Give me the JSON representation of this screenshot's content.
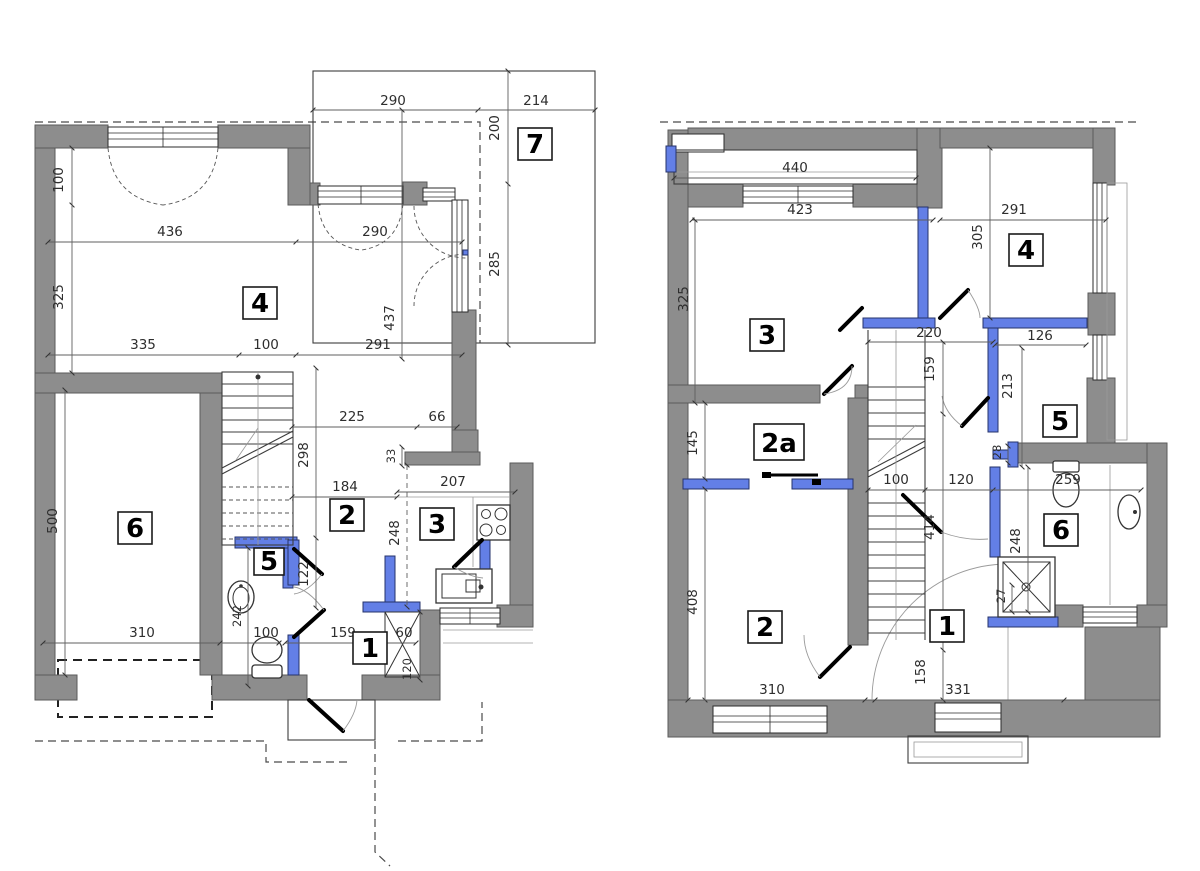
{
  "colors": {
    "wall_gray": "#8d8d8d",
    "partition_blue": "#637fe6",
    "line_dark": "#3c3c3c",
    "dimension_text": "#2e2e2e"
  },
  "left_plan": {
    "name": "ground floor plan",
    "rooms": [
      "4",
      "6",
      "2",
      "3",
      "5",
      "1",
      "7"
    ],
    "dims": [
      "290",
      "214",
      "200",
      "285",
      "100",
      "436",
      "290",
      "325",
      "437",
      "335",
      "100",
      "291",
      "225",
      "66",
      "298",
      "33",
      "184",
      "207",
      "248",
      "122",
      "242",
      "500",
      "310",
      "100",
      "159",
      "60",
      "120"
    ],
    "fixtures": [
      "stairs",
      "wc-sink",
      "toilet",
      "kitchen-stove",
      "kitchen-sink",
      "wardrobe",
      "terrace",
      "entry-porch",
      "garage-door",
      "french-window"
    ]
  },
  "right_plan": {
    "name": "upper floor plan",
    "rooms": [
      "3",
      "4",
      "2a",
      "2",
      "5",
      "6",
      "1"
    ],
    "dims": [
      "440",
      "423",
      "291",
      "305",
      "325",
      "220",
      "126",
      "159",
      "213",
      "28",
      "100",
      "120",
      "259",
      "414",
      "248",
      "27",
      "145",
      "408",
      "158",
      "310",
      "331"
    ],
    "fixtures": [
      "stairs",
      "toilet",
      "washbasin",
      "shower",
      "balcony",
      "sliding-door",
      "window"
    ]
  }
}
